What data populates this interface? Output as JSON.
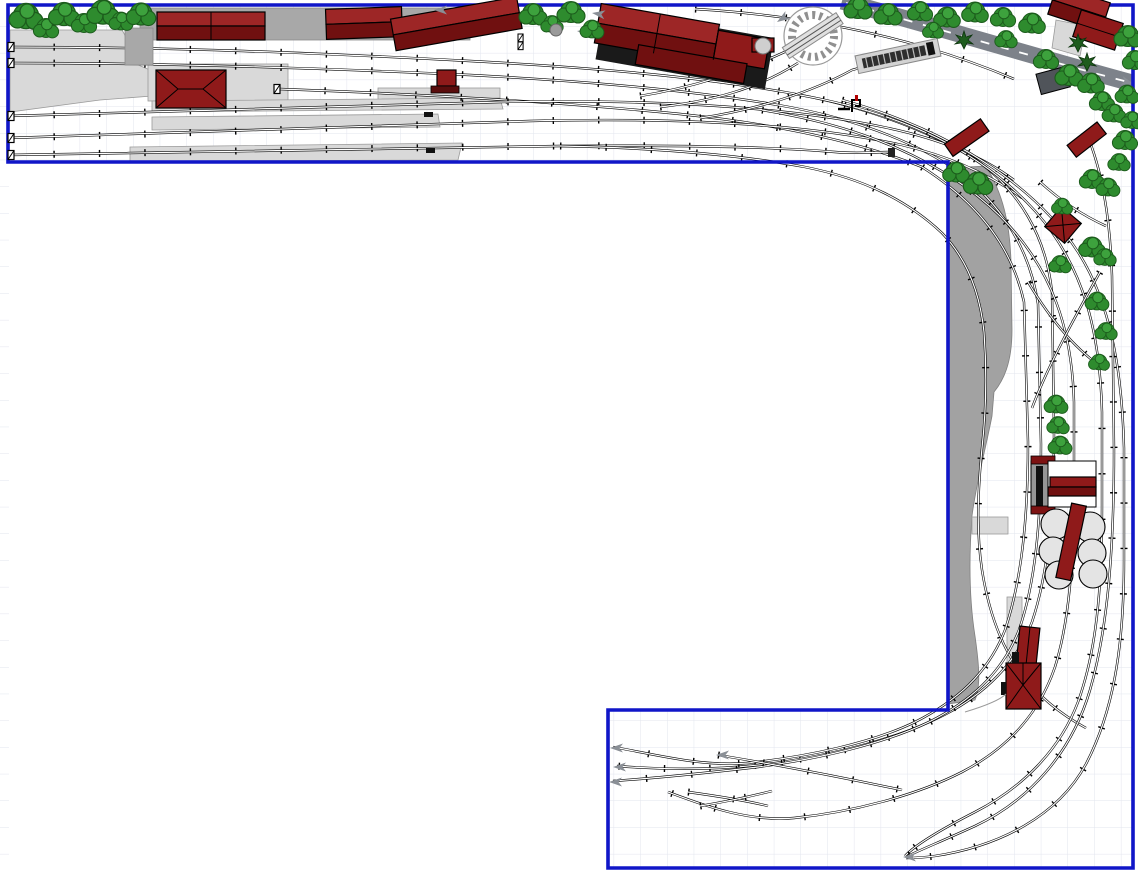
{
  "app": {
    "type": "model-railway-track-plan-canvas",
    "visible_text": "none"
  },
  "canvas": {
    "width_px": 1138,
    "height_px": 876
  },
  "colors": {
    "background": "#ffffff",
    "room_border": "#1016c8",
    "grid_line": "#e2e5ee",
    "track": "#000000",
    "building_red": "#8f1a1a",
    "building_red_dark": "#701010",
    "building_red_light": "#9d2626",
    "building_gray_dark": "#50545a",
    "paved_light": "#d9d9d9",
    "paved_mid": "#a8a8a8",
    "hill_gray": "#a2a2a2",
    "tank_gray": "#e4e4e4",
    "road_gray": "#7d828a",
    "road_centerline": "#ffffff",
    "tree_green": "#2e8b2e",
    "tree_green_light": "#3da23d",
    "tree_green_dark": "#1c5c1c",
    "conifer_green": "#1e5c1e",
    "arrow_gray": "#8a8f96"
  },
  "plan": {
    "regions": [
      "top-yard-strip",
      "right-curve-section",
      "bottom-staging-section"
    ],
    "features": [
      "station-buildings",
      "goods-shed",
      "platforms",
      "turntable",
      "coaling-stage",
      "storage-tanks",
      "factory-complex",
      "hillside",
      "road-with-centerline",
      "tree-rows",
      "track-end-bumpers",
      "connection-arrows",
      "crossovers"
    ],
    "counts": {
      "track_exit_arrows": 5,
      "left_edge_bumpers": 5,
      "storage_tanks": 6
    }
  }
}
